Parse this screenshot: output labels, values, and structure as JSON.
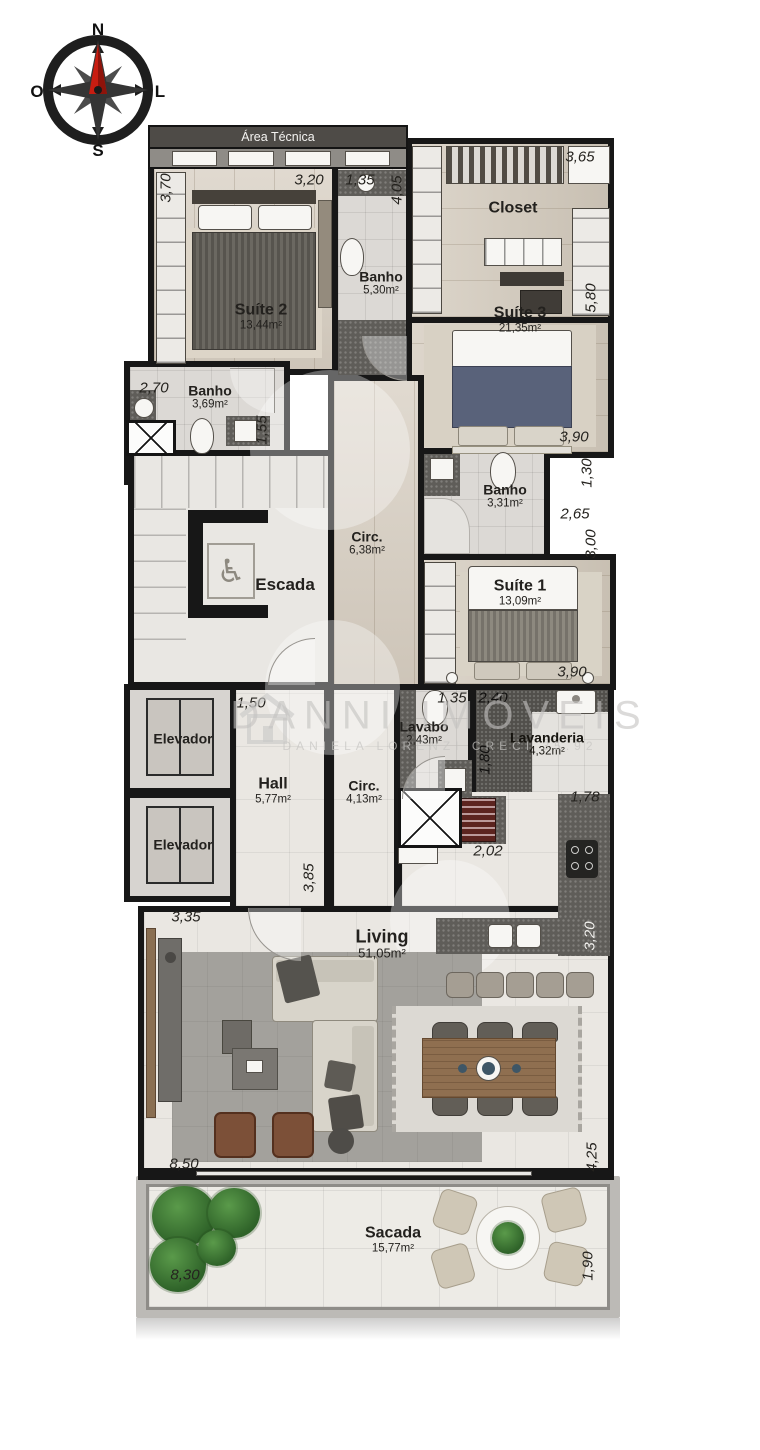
{
  "compass": {
    "north": "N",
    "south": "S",
    "west": "O",
    "east": "L"
  },
  "header": {
    "area_tecnica": "Área Técnica"
  },
  "watermark": {
    "brand": "DANNI IMÓVEIS",
    "subtitle": "DANIELA LORENZI   CRECI 35.92"
  },
  "icons": {
    "wheelchair": "♿"
  },
  "rooms": {
    "suite2": {
      "name": "Suíte 2",
      "area": "13,44m²"
    },
    "banho_suite2": {
      "name": "Banho",
      "area": "5,30m²"
    },
    "closet": {
      "name": "Closet",
      "area": ""
    },
    "suite3": {
      "name": "Suíte 3",
      "area": "21,35m²"
    },
    "banho_social": {
      "name": "Banho",
      "area": "3,69m²"
    },
    "escada": {
      "name": "Escada",
      "area": ""
    },
    "circ_superior": {
      "name": "Circ.",
      "area": "6,38m²"
    },
    "banho_suite1": {
      "name": "Banho",
      "area": "3,31m²"
    },
    "suite1": {
      "name": "Suíte 1",
      "area": "13,09m²"
    },
    "elevador1": {
      "name": "Elevador",
      "area": ""
    },
    "elevador2": {
      "name": "Elevador",
      "area": ""
    },
    "hall": {
      "name": "Hall",
      "area": "5,77m²"
    },
    "lavabo": {
      "name": "Lavabo",
      "area": "2,43m²"
    },
    "circ_inferior": {
      "name": "Circ.",
      "area": "4,13m²"
    },
    "lavanderia": {
      "name": "Lavanderia",
      "area": "4,32m²"
    },
    "living": {
      "name": "Living",
      "area": "51,05m²"
    },
    "sacada": {
      "name": "Sacada",
      "area": "15,77m²"
    }
  },
  "dimensions": {
    "d370": "3,70",
    "d320_top": "3,20",
    "d135_top": "1,35",
    "d405": "4,05",
    "d365": "3,65",
    "d580": "5,80",
    "d270": "2,70",
    "d155": "1,55",
    "d390_suite3": "3,90",
    "d130": "1,30",
    "d265": "2,65",
    "d300": "3,00",
    "d390_suite1": "3,90",
    "d150": "1,50",
    "d135_lavabo": "1,35",
    "d240": "2,40",
    "d180": "1,80",
    "d178": "1,78",
    "d202": "2,02",
    "d385": "3,85",
    "d320_kitchen": "3,20",
    "d335": "3,35",
    "d850": "8,50",
    "d425": "4,25",
    "d830": "8,30",
    "d190": "1,90"
  },
  "colors": {
    "wall": "#171717",
    "wood": "#d6cdc0",
    "tile": "#dcd9d5",
    "granite": "#5f5d59",
    "needle_red": "#c81d11",
    "plant_green": "#3a7a33"
  }
}
